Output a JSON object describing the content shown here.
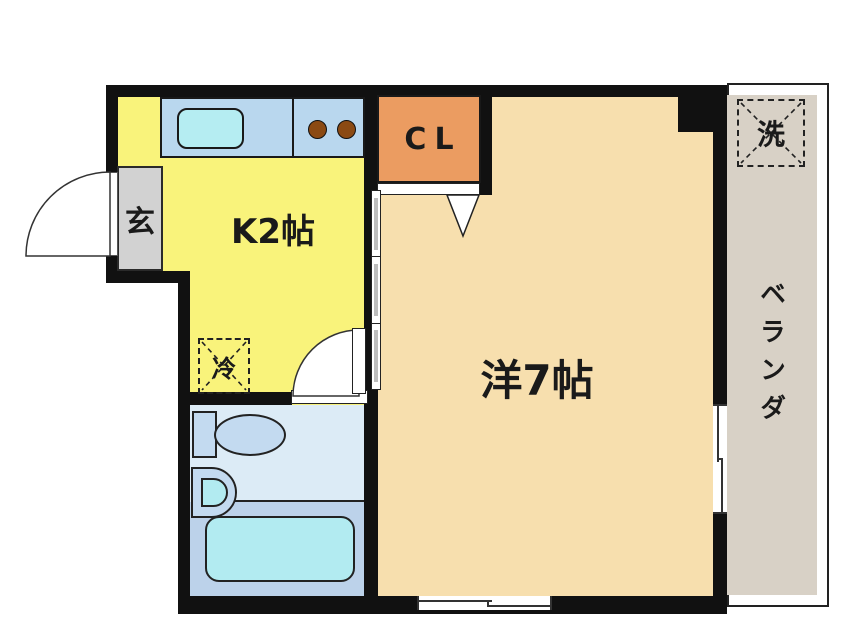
{
  "floorplan": {
    "title": "1K apartment floor plan",
    "rooms": {
      "kitchen": {
        "label": "K2帖"
      },
      "main_room": {
        "label": "洋7帖"
      },
      "closet": {
        "label": "CL"
      },
      "entrance": {
        "label": "玄"
      },
      "balcony": {
        "label": "ベランダ"
      },
      "washer_space": {
        "label": "洗"
      },
      "refrigerator_space": {
        "label": "冷"
      }
    },
    "colors": {
      "wall": "#111111",
      "kitchen": "#f9f37b",
      "main_room": "#f7dfae",
      "closet": "#eb9c61",
      "balcony": "#d8d1c6",
      "entrance": "#d2d2d2",
      "counter": "#b9d7ee",
      "sink": "#b5edf2",
      "burner": "#8b4a13",
      "bathroom_upper": "#dcebf6",
      "bathroom_lower": "#bcd2ea",
      "fixture": "#c3daf0",
      "tub": "#b2ebf1"
    }
  }
}
